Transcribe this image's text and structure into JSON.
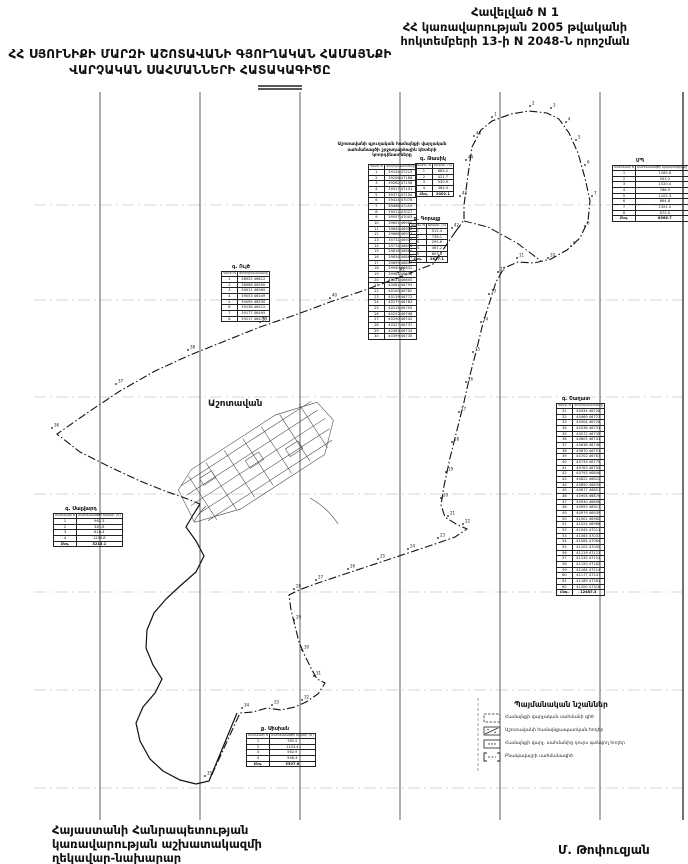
{
  "appendix": {
    "l1": "Հավելված N  1",
    "l2": "ՀՀ կառավարության 2005 թվականի",
    "l3": "հոկտեմբերի 13-ի N 2048-Ն որոշման"
  },
  "title": {
    "l1": "ՀՀ ՍՅՈՒՆԻՔԻ ՄԱՐԶԻ ԱՇՈՏԱՎԱՆԻ ԳՅՈՒՂԱԿԱՆ ՀԱՄԱՅՆՔԻ",
    "l2": "ՎԱՐՉԱԿԱՆ  ՍԱՀՄԱՆՆԵՐԻ  ՀԱՏԱԿԱԳԻԾԸ"
  },
  "footer": {
    "l1": "Հայաստանի Հանրապետության",
    "l2": "կառավարության աշխատակազմի",
    "l3": "ղեկավար-նախարար",
    "signature": "Մ. Թոփուզյան"
  },
  "map": {
    "settlement_label": "Աշոտավան",
    "grid": {
      "verticals": [
        100,
        200,
        300,
        400,
        500,
        600,
        683
      ],
      "horizontals": [
        205,
        300,
        397,
        494,
        592,
        690,
        788
      ]
    },
    "boundary_points": [
      {
        "n": "1",
        "x": 492,
        "y": 117
      },
      {
        "n": "2",
        "x": 530,
        "y": 106
      },
      {
        "n": "3",
        "x": 551,
        "y": 108
      },
      {
        "n": "4",
        "x": 566,
        "y": 122
      },
      {
        "n": "5",
        "x": 576,
        "y": 140
      },
      {
        "n": "6",
        "x": 585,
        "y": 165
      },
      {
        "n": "7",
        "x": 592,
        "y": 196
      },
      {
        "n": "8",
        "x": 585,
        "y": 226
      },
      {
        "n": "9",
        "x": 571,
        "y": 246
      },
      {
        "n": "10",
        "x": 548,
        "y": 258
      },
      {
        "n": "11",
        "x": 517,
        "y": 258
      },
      {
        "n": "12",
        "x": 498,
        "y": 272
      },
      {
        "n": "13",
        "x": 489,
        "y": 294
      },
      {
        "n": "14",
        "x": 481,
        "y": 322
      },
      {
        "n": "15",
        "x": 473,
        "y": 352
      },
      {
        "n": "16",
        "x": 466,
        "y": 382
      },
      {
        "n": "17",
        "x": 459,
        "y": 412
      },
      {
        "n": "18",
        "x": 452,
        "y": 442
      },
      {
        "n": "19",
        "x": 446,
        "y": 472
      },
      {
        "n": "20",
        "x": 441,
        "y": 498
      },
      {
        "n": "21",
        "x": 448,
        "y": 516
      },
      {
        "n": "22",
        "x": 463,
        "y": 524
      },
      {
        "n": "23",
        "x": 438,
        "y": 538
      },
      {
        "n": "24",
        "x": 408,
        "y": 549
      },
      {
        "n": "25",
        "x": 378,
        "y": 559
      },
      {
        "n": "26",
        "x": 348,
        "y": 569
      },
      {
        "n": "27",
        "x": 316,
        "y": 580
      },
      {
        "n": "28",
        "x": 294,
        "y": 589
      },
      {
        "n": "29",
        "x": 294,
        "y": 620
      },
      {
        "n": "30",
        "x": 302,
        "y": 650
      },
      {
        "n": "31",
        "x": 314,
        "y": 676
      },
      {
        "n": "32",
        "x": 302,
        "y": 700
      },
      {
        "n": "33",
        "x": 272,
        "y": 705
      },
      {
        "n": "34",
        "x": 242,
        "y": 708
      },
      {
        "n": "35",
        "x": 205,
        "y": 776
      },
      {
        "n": "36",
        "x": 52,
        "y": 428
      },
      {
        "n": "37",
        "x": 116,
        "y": 384
      },
      {
        "n": "38",
        "x": 188,
        "y": 350
      },
      {
        "n": "39",
        "x": 260,
        "y": 322
      },
      {
        "n": "40",
        "x": 330,
        "y": 298
      },
      {
        "n": "41",
        "x": 398,
        "y": 272
      },
      {
        "n": "42",
        "x": 452,
        "y": 228
      },
      {
        "n": "43",
        "x": 460,
        "y": 196
      },
      {
        "n": "44",
        "x": 466,
        "y": 160
      },
      {
        "n": "45",
        "x": 474,
        "y": 136
      }
    ]
  },
  "tables": [
    {
      "id": "coords-main",
      "x": 368,
      "y": 142,
      "w": 36,
      "caption_w": 116,
      "caption_x": 334,
      "caption": "Աշոտավանի գյուղական համայնքի վարչական սահմանագծի շրջադարձային կետերի կոորդինատները",
      "title": "",
      "headers": [
        "Կետի N",
        "Կոորդինատները"
      ],
      "rows": [
        [
          "1",
          "39154 47215"
        ],
        [
          "2",
          "39208 47186"
        ],
        [
          "3",
          "39262 47158"
        ],
        [
          "4",
          "39317 47131"
        ],
        [
          "5",
          "39371 47104"
        ],
        [
          "6",
          "39424 47078"
        ],
        [
          "7",
          "39468 47052"
        ],
        [
          "8",
          "39512 47027"
        ],
        [
          "9",
          "39557 47003"
        ],
        [
          "10",
          "39601 46980"
        ],
        [
          "11",
          "39645 46958"
        ],
        [
          "12",
          "39688 46937"
        ],
        [
          "13",
          "39731 46917"
        ],
        [
          "14",
          "39774 46898"
        ],
        [
          "15",
          "39816 46880"
        ],
        [
          "16",
          "39858 46863"
        ],
        [
          "17",
          "39899 46847"
        ],
        [
          "18",
          "39940 46832"
        ],
        [
          "19",
          "39981 46818"
        ],
        [
          "20",
          "40021 46805"
        ],
        [
          "21",
          "40061 46793"
        ],
        [
          "22",
          "40100 46782"
        ],
        [
          "23",
          "40139 46772"
        ],
        [
          "24",
          "40177 46763"
        ],
        [
          "25",
          "40215 46755"
        ],
        [
          "26",
          "40253 46748"
        ],
        [
          "27",
          "40290 46742"
        ],
        [
          "28",
          "40327 46737"
        ],
        [
          "29",
          "40363 46733"
        ],
        [
          "30",
          "40399 46730"
        ]
      ],
      "total": null
    },
    {
      "id": "tasik",
      "x": 415,
      "y": 156,
      "w": 36,
      "caption": "",
      "title": "գ. Թասիկ",
      "headers": [
        "Սահմ. N",
        "Երկար. (մ)"
      ],
      "rows": [
        [
          "1",
          "685.2"
        ],
        [
          "2",
          "421.7"
        ],
        [
          "3",
          "530.9"
        ],
        [
          "4",
          "364.3"
        ]
      ],
      "total": [
        "Ընդ.",
        "2002.1"
      ]
    },
    {
      "id": "gorayk",
      "x": 409,
      "y": 216,
      "w": 36,
      "caption": "",
      "title": "գ. Գորայք",
      "headers": [
        "Սահմ. N",
        "Երկար. (մ)"
      ],
      "rows": [
        [
          "1",
          "512.4"
        ],
        [
          "2",
          "738.1"
        ],
        [
          "3",
          "295.6"
        ],
        [
          "4",
          "467.2"
        ],
        [
          "5",
          "603.8"
        ]
      ],
      "total": [
        "Ընդ.",
        "2617.1"
      ]
    },
    {
      "id": "mp",
      "x": 612,
      "y": 158,
      "w": 56,
      "caption": "",
      "title": "ՄՊ",
      "headers": [
        "Սահմանի N",
        "Սահմանագծի երկարությունը (մ)"
      ],
      "rows": [
        [
          "1",
          "1285.6"
        ],
        [
          "2",
          "943.2"
        ],
        [
          "3",
          "1520.4"
        ],
        [
          "4",
          "786.9"
        ],
        [
          "5",
          "1102.3"
        ],
        [
          "6",
          "664.8"
        ],
        [
          "7",
          "1391.5"
        ],
        [
          "8",
          "872.0"
        ]
      ],
      "total": [
        "Ընդ.",
        "8566.7"
      ]
    },
    {
      "id": "uyts",
      "x": 221,
      "y": 264,
      "w": 40,
      "caption": "",
      "title": "գ. Ույծ",
      "headers": [
        "Կետի N",
        "Կոորդինատները"
      ],
      "rows": [
        [
          "1",
          "38925 46612"
        ],
        [
          "2",
          "38968 46590"
        ],
        [
          "3",
          "39011 46569"
        ],
        [
          "4",
          "39053 46549"
        ],
        [
          "5",
          "39095 46530"
        ],
        [
          "6",
          "39136 46512"
        ],
        [
          "7",
          "39177 46495"
        ],
        [
          "8",
          "39217 46479"
        ]
      ],
      "total": null
    },
    {
      "id": "shaghat",
      "x": 556,
      "y": 396,
      "w": 40,
      "caption": "",
      "title": "գ. Շաղատ",
      "headers": [
        "Կետի N",
        "Կոորդինատները"
      ],
      "rows": [
        [
          "31",
          "40434 46728"
        ],
        [
          "32",
          "40469 46727"
        ],
        [
          "33",
          "40504 46728"
        ],
        [
          "34",
          "40538 46731"
        ],
        [
          "35",
          "40572 46735"
        ],
        [
          "36",
          "40605 46741"
        ],
        [
          "37",
          "40638 46748"
        ],
        [
          "38",
          "40670 46757"
        ],
        [
          "39",
          "40702 46767"
        ],
        [
          "40",
          "40733 46779"
        ],
        [
          "41",
          "40763 46792"
        ],
        [
          "42",
          "40793 46806"
        ],
        [
          "43",
          "40822 46822"
        ],
        [
          "44",
          "40850 46839"
        ],
        [
          "45",
          "40877 46857"
        ],
        [
          "46",
          "40904 46876"
        ],
        [
          "47",
          "40930 46896"
        ],
        [
          "48",
          "40955 46917"
        ],
        [
          "49",
          "40979 46939"
        ],
        [
          "50",
          "41002 46962"
        ],
        [
          "51",
          "41024 46986"
        ],
        [
          "52",
          "41045 47011"
        ],
        [
          "53",
          "41065 47037"
        ],
        [
          "54",
          "41084 47064"
        ],
        [
          "55",
          "41102 47092"
        ],
        [
          "56",
          "41119 47121"
        ],
        [
          "57",
          "41135 47151"
        ],
        [
          "58",
          "41150 47182"
        ],
        [
          "59",
          "41164 47214"
        ],
        [
          "60",
          "41177 47247"
        ],
        [
          "61",
          "41189 47281"
        ],
        [
          "62",
          "41200 47316"
        ]
      ],
      "total": [
        "Ընդ.",
        "12487.3"
      ]
    },
    {
      "id": "salvard",
      "x": 53,
      "y": 506,
      "w": 56,
      "caption": "",
      "title": "գ. Սալվարդ",
      "headers": [
        "Սահմանի N",
        "Սահմանագծի երկար. (մ)"
      ],
      "rows": [
        [
          "1",
          "962.3"
        ],
        [
          "2",
          "381.6"
        ],
        [
          "3",
          "618.4"
        ],
        [
          "4",
          "1250.8"
        ]
      ],
      "total": [
        "Ընդ.",
        "3213.1"
      ]
    },
    {
      "id": "sisian",
      "x": 246,
      "y": 726,
      "w": 58,
      "caption": "",
      "title": "ք. Սիսիան",
      "headers": [
        "Սահմանի N",
        "Սահմանագծի երկար. (մ)"
      ],
      "rows": [
        [
          "1",
          "785.2"
        ],
        [
          "2",
          "1103.4"
        ],
        [
          "3",
          "562.9"
        ],
        [
          "4",
          "946.3"
        ]
      ],
      "total": [
        "Ընդ.",
        "3397.8"
      ]
    }
  ],
  "legend": {
    "title": "Պայմանական նշաններ",
    "items": [
      {
        "symbol": "dash-box",
        "label": "Համայնքի վարչական սահմանի գիծ"
      },
      {
        "symbol": "hatch-box",
        "label": "Աշոտավանի համայնքապատկան հողեր"
      },
      {
        "symbol": "dot-box",
        "label": "Համայնքի վարչ. սահմանից դուրս գտնվող հողեր"
      },
      {
        "symbol": "bracket-box",
        "label": "Բնակավայրի սահմանագիծ"
      }
    ]
  }
}
